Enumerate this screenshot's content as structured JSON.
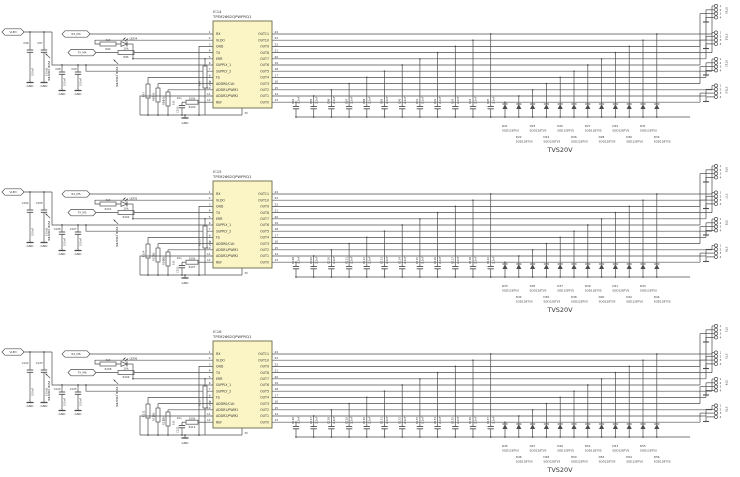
{
  "colors": {
    "wire": "#4d4d4d",
    "text": "#333333",
    "ic_fill": "#fbf5c5",
    "ic_border": "#6b6b4a",
    "background": "#ffffff"
  },
  "ic_template": {
    "pins_left": [
      {
        "num": "1",
        "name": "RX"
      },
      {
        "num": "2",
        "name": "VLDO"
      },
      {
        "num": "3",
        "name": "GND"
      },
      {
        "num": "4",
        "name": "TX"
      },
      {
        "num": "5",
        "name": "ERR"
      },
      {
        "num": "6",
        "name": "SUPPLY_1"
      },
      {
        "num": "7",
        "name": "SUPPLY_2"
      },
      {
        "num": "8",
        "name": "FS"
      },
      {
        "num": "9",
        "name": "ADDR0/CLK"
      },
      {
        "num": "10",
        "name": "ADDR1/PWM1"
      },
      {
        "num": "11",
        "name": "ADDR2/PWM2"
      },
      {
        "num": "12",
        "name": "REF"
      }
    ],
    "pins_right": [
      {
        "num": "24",
        "name": "OUT11"
      },
      {
        "num": "23",
        "name": "OUT10"
      },
      {
        "num": "22",
        "name": "OUT9"
      },
      {
        "num": "21",
        "name": "OUT8"
      },
      {
        "num": "20",
        "name": "OUT7"
      },
      {
        "num": "19",
        "name": "OUT6"
      },
      {
        "num": "18",
        "name": "OUT5"
      },
      {
        "num": "17",
        "name": "OUT4"
      },
      {
        "num": "16",
        "name": "OUT3"
      },
      {
        "num": "15",
        "name": "OUT2"
      },
      {
        "num": "14",
        "name": "OUT1"
      },
      {
        "num": "13",
        "name": "OUT0"
      }
    ],
    "pad_num": "25"
  },
  "blocks": [
    {
      "ic_ref": "IC14",
      "ic_part": "TPS92662QPWPRQ1",
      "supply_tag": "VLED",
      "rx_tag": "RX_M4",
      "tx_tag": "TX_M4",
      "led": {
        "ref": "LED4"
      },
      "pwr_label": "PWR_DRIVER",
      "gnd_label": "GND",
      "tag_caps": [
        {
          "ref": "C96",
          "value": "100nF"
        },
        {
          "ref": "C97",
          "value": "100nF"
        }
      ],
      "supply_caps": [
        {
          "ref": "C98",
          "value": "100nF"
        },
        {
          "ref": "C99",
          "value": "100nF"
        }
      ],
      "ref_cap": {
        "ref": "C100",
        "value": "10n"
      },
      "res_led": {
        "ref": "R94",
        "value": "4k7"
      },
      "res_tx": {
        "ref": "R95",
        "value": "10k"
      },
      "res_err": {
        "ref": "R96",
        "value": "20k"
      },
      "res_pulldown": [
        {
          "ref": "R97",
          "value": "10k"
        },
        {
          "ref": "R98",
          "value": "10k"
        },
        {
          "ref": "R99",
          "value": "10k"
        }
      ],
      "res_ref": {
        "ref": "R100",
        "value": "100k"
      },
      "out_caps": [
        {
          "ref": "C84",
          "value": "2.2nF"
        },
        {
          "ref": "C85",
          "value": "2.2nF"
        },
        {
          "ref": "C86",
          "value": "2.2nF"
        },
        {
          "ref": "C87",
          "value": "2.2nF"
        },
        {
          "ref": "C88",
          "value": "2.2nF"
        },
        {
          "ref": "C89",
          "value": "2.2nF"
        },
        {
          "ref": "C90",
          "value": "2.2nF"
        },
        {
          "ref": "C91",
          "value": "2.2nF"
        },
        {
          "ref": "C92",
          "value": "2.2nF"
        },
        {
          "ref": "C93",
          "value": "2.2nF"
        },
        {
          "ref": "C94",
          "value": "2.2nF"
        },
        {
          "ref": "C95",
          "value": "2.2nF"
        }
      ],
      "tvs_diodes": [
        {
          "ref": "D21",
          "part": "SOD128TVS"
        },
        {
          "ref": "D22",
          "part": "SOD128TVS"
        },
        {
          "ref": "D23",
          "part": "SOD128TVS"
        },
        {
          "ref": "D24",
          "part": "SOD128TVS"
        },
        {
          "ref": "D25",
          "part": "SOD128TVS"
        },
        {
          "ref": "D26",
          "part": "SOD128TVS"
        },
        {
          "ref": "D27",
          "part": "SOD128TVS"
        },
        {
          "ref": "D28",
          "part": "SOD128TVS"
        },
        {
          "ref": "D29",
          "part": "SOD128TVS"
        },
        {
          "ref": "D30",
          "part": "SOD128TVS"
        },
        {
          "ref": "D31",
          "part": "SOD128TVS"
        },
        {
          "ref": "D32",
          "part": "SOD128TVS"
        }
      ],
      "tvs_label": "TVS20V",
      "connectors": [
        {
          "name": "ST10",
          "pins": [
            "1",
            "2",
            "3",
            "4"
          ]
        },
        {
          "name": "ST11",
          "pins": [
            "1",
            "2",
            "3",
            "4"
          ]
        },
        {
          "name": "ST12",
          "pins": [
            "1",
            "2",
            "3",
            "4"
          ]
        },
        {
          "name": "ST13",
          "pins": [
            "1",
            "2",
            "3",
            "4"
          ]
        }
      ]
    },
    {
      "ic_ref": "IC15",
      "ic_part": "TPS92662QPWPRQ1",
      "supply_tag": "VLED",
      "rx_tag": "RX_M5",
      "tx_tag": "TX_M5",
      "led": {
        "ref": "LED5"
      },
      "pwr_label": "PWR_DRIVER",
      "gnd_label": "GND",
      "tag_caps": [
        {
          "ref": "C104",
          "value": "100nF"
        },
        {
          "ref": "C105",
          "value": "100nF"
        }
      ],
      "supply_caps": [
        {
          "ref": "C106",
          "value": "100nF"
        },
        {
          "ref": "C107",
          "value": "100nF"
        }
      ],
      "ref_cap": {
        "ref": "C103",
        "value": "10n"
      },
      "res_led": {
        "ref": "R101",
        "value": "4k7"
      },
      "res_tx": {
        "ref": "R102",
        "value": "10k"
      },
      "res_err": {
        "ref": "R103",
        "value": "20k"
      },
      "res_pulldown": [
        {
          "ref": "R104",
          "value": "10k"
        },
        {
          "ref": "R105",
          "value": "10k"
        },
        {
          "ref": "R106",
          "value": "10k"
        }
      ],
      "res_ref": {
        "ref": "R107",
        "value": "100k"
      },
      "out_caps": [
        {
          "ref": "C108",
          "value": "2.2nF"
        },
        {
          "ref": "C109",
          "value": "2.2nF"
        },
        {
          "ref": "C110",
          "value": "2.2nF"
        },
        {
          "ref": "C111",
          "value": "2.2nF"
        },
        {
          "ref": "C112",
          "value": "2.2nF"
        },
        {
          "ref": "C113",
          "value": "2.2nF"
        },
        {
          "ref": "C114",
          "value": "2.2nF"
        },
        {
          "ref": "C115",
          "value": "2.2nF"
        },
        {
          "ref": "C116",
          "value": "2.2nF"
        },
        {
          "ref": "C117",
          "value": "2.2nF"
        },
        {
          "ref": "C118",
          "value": "2.2nF"
        },
        {
          "ref": "C119",
          "value": "2.2nF"
        }
      ],
      "tvs_diodes": [
        {
          "ref": "D33",
          "part": "SOD128TVS"
        },
        {
          "ref": "D34",
          "part": "SOD128TVS"
        },
        {
          "ref": "D35",
          "part": "SOD128TVS"
        },
        {
          "ref": "D36",
          "part": "SOD128TVS"
        },
        {
          "ref": "D37",
          "part": "SOD128TVS"
        },
        {
          "ref": "D38",
          "part": "SOD128TVS"
        },
        {
          "ref": "D39",
          "part": "SOD128TVS"
        },
        {
          "ref": "D40",
          "part": "SOD128TVS"
        },
        {
          "ref": "D41",
          "part": "SOD128TVS"
        },
        {
          "ref": "D42",
          "part": "SOD128TVS"
        },
        {
          "ref": "D43",
          "part": "SOD128TVS"
        },
        {
          "ref": "D44",
          "part": "SOD128TVS"
        }
      ],
      "tvs_label": "TVS20V",
      "connectors": [
        {
          "name": "ST6",
          "pins": [
            "1",
            "2",
            "3",
            "4"
          ]
        },
        {
          "name": "ST7",
          "pins": [
            "1",
            "2",
            "3",
            "4"
          ]
        },
        {
          "name": "ST8",
          "pins": [
            "1",
            "2",
            "3",
            "4"
          ]
        },
        {
          "name": "ST9",
          "pins": [
            "1",
            "2",
            "3",
            "4"
          ]
        }
      ]
    },
    {
      "ic_ref": "IC16",
      "ic_part": "TPS92662QPWPRQ1",
      "supply_tag": "VLED",
      "rx_tag": "RX_M6",
      "tx_tag": "TX_M6",
      "led": {
        "ref": "LED6"
      },
      "pwr_label": "PWR_DRIVER",
      "gnd_label": "GND",
      "tag_caps": [
        {
          "ref": "C122",
          "value": "100nF"
        },
        {
          "ref": "C123",
          "value": "100nF"
        }
      ],
      "supply_caps": [
        {
          "ref": "C124",
          "value": "100nF"
        },
        {
          "ref": "C125",
          "value": "100nF"
        }
      ],
      "ref_cap": {
        "ref": "C121",
        "value": "10n"
      },
      "res_led": {
        "ref": "R108",
        "value": "4k7"
      },
      "res_tx": {
        "ref": "R109",
        "value": "10k"
      },
      "res_err": {
        "ref": "R110",
        "value": "20k"
      },
      "res_pulldown": [
        {
          "ref": "R111",
          "value": "10k"
        },
        {
          "ref": "R112",
          "value": "10k"
        },
        {
          "ref": "R113",
          "value": "10k"
        }
      ],
      "res_ref": {
        "ref": "R114",
        "value": "100k"
      },
      "out_caps": [
        {
          "ref": "C126",
          "value": "2.2nF"
        },
        {
          "ref": "C127",
          "value": "2.2nF"
        },
        {
          "ref": "C128",
          "value": "2.2nF"
        },
        {
          "ref": "C129",
          "value": "2.2nF"
        },
        {
          "ref": "C130",
          "value": "2.2nF"
        },
        {
          "ref": "C131",
          "value": "2.2nF"
        },
        {
          "ref": "C132",
          "value": "2.2nF"
        },
        {
          "ref": "C133",
          "value": "2.2nF"
        },
        {
          "ref": "C134",
          "value": "2.2nF"
        },
        {
          "ref": "C135",
          "value": "2.2nF"
        },
        {
          "ref": "C136",
          "value": "2.2nF"
        },
        {
          "ref": "C137",
          "value": "2.2nF"
        }
      ],
      "tvs_diodes": [
        {
          "ref": "D45",
          "part": "SOD128TVS"
        },
        {
          "ref": "D46",
          "part": "SOD128TVS"
        },
        {
          "ref": "D47",
          "part": "SOD128TVS"
        },
        {
          "ref": "D48",
          "part": "SOD128TVS"
        },
        {
          "ref": "D49",
          "part": "SOD128TVS"
        },
        {
          "ref": "D50",
          "part": "SOD128TVS"
        },
        {
          "ref": "D51",
          "part": "SOD128TVS"
        },
        {
          "ref": "D52",
          "part": "SOD128TVS"
        },
        {
          "ref": "D53",
          "part": "SOD128TVS"
        },
        {
          "ref": "D54",
          "part": "SOD128TVS"
        },
        {
          "ref": "D55",
          "part": "SOD128TVS"
        },
        {
          "ref": "D56",
          "part": "SOD128TVS"
        }
      ],
      "tvs_label": "TVS20V",
      "connectors": [
        {
          "name": "ST2",
          "pins": [
            "1",
            "2",
            "3",
            "4"
          ]
        },
        {
          "name": "ST3",
          "pins": [
            "1",
            "2",
            "3",
            "4"
          ]
        },
        {
          "name": "ST4",
          "pins": [
            "1",
            "2",
            "3",
            "4"
          ]
        },
        {
          "name": "ST5",
          "pins": [
            "1",
            "2",
            "3",
            "4"
          ]
        }
      ]
    }
  ]
}
